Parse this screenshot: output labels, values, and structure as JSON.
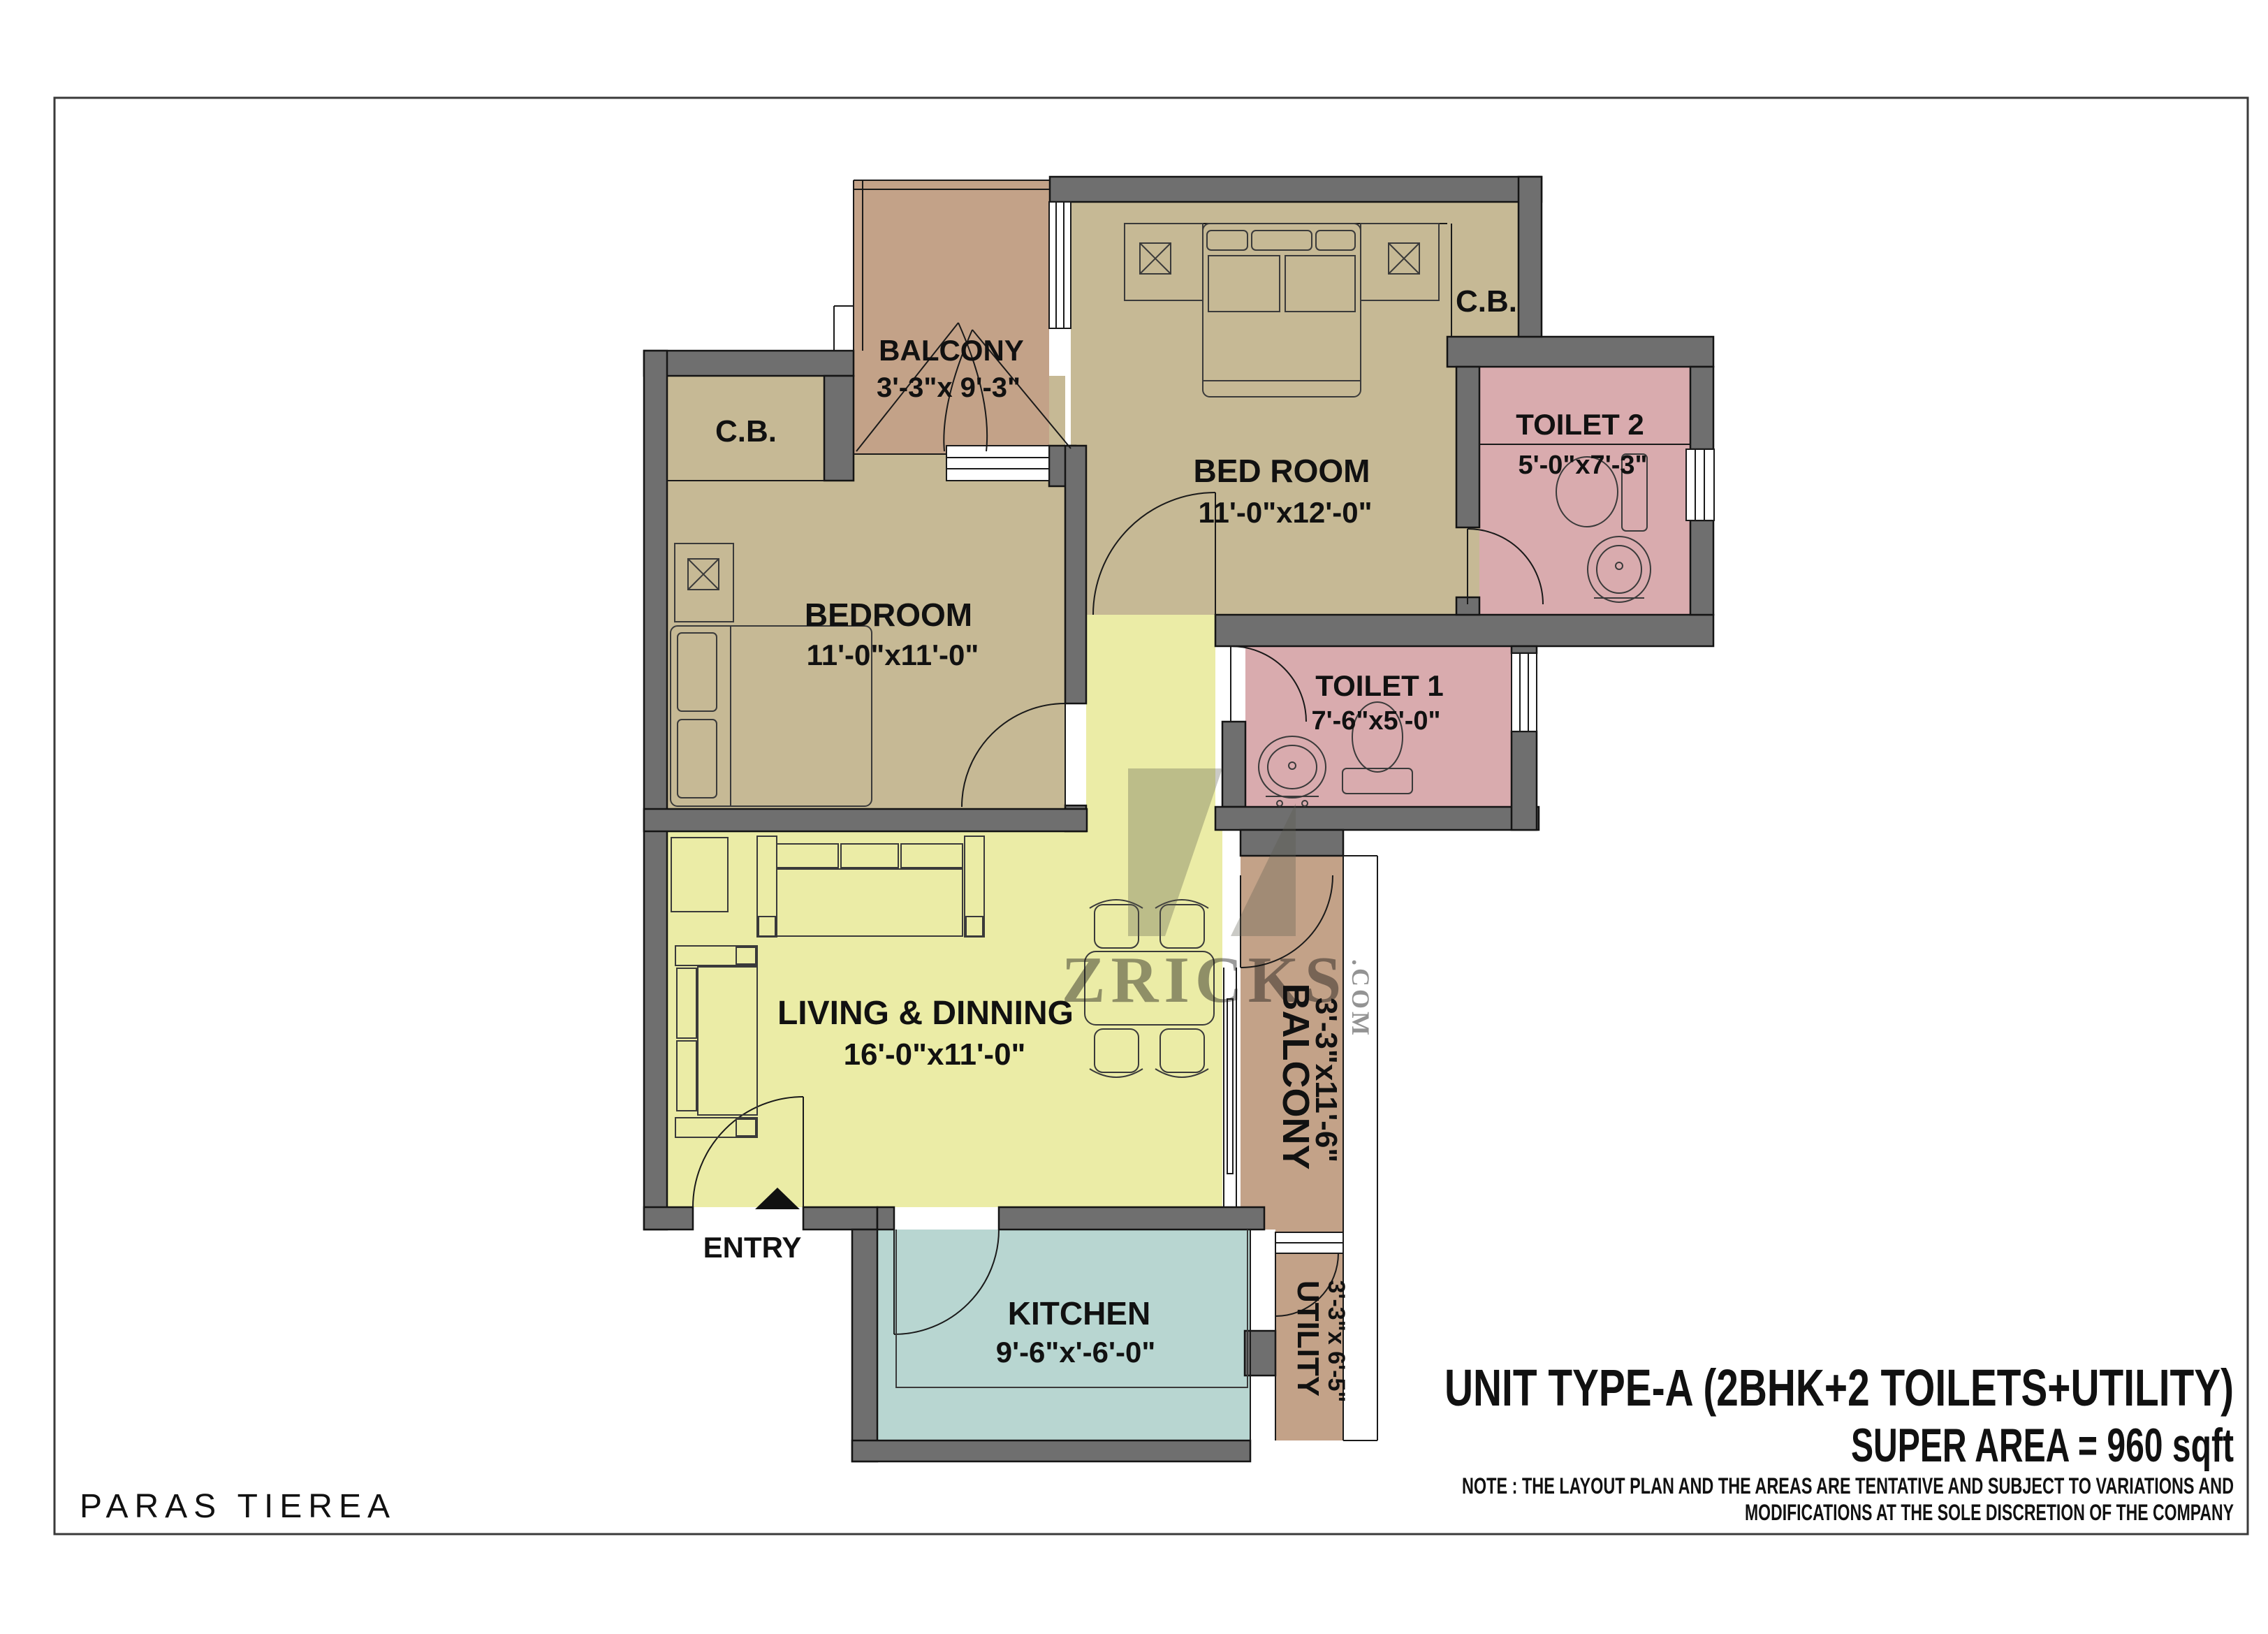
{
  "project": {
    "name": "PARAS TIEREA"
  },
  "title_block": {
    "unit_title": "UNIT TYPE-A (2BHK+2 TOILETS+UTILITY)",
    "super_area": "SUPER AREA = 960 sqft",
    "note_line1": "NOTE : THE LAYOUT PLAN AND THE AREAS ARE TENTATIVE AND SUBJECT TO VARIATIONS AND",
    "note_line2": "MODIFICATIONS AT THE SOLE DISCRETION OF THE COMPANY"
  },
  "watermark": {
    "name": "ZRICKS",
    "suffix": ".COM"
  },
  "rooms": {
    "balcony_top": {
      "name": "BALCONY",
      "dims": "3'-3\"x 9'-3\""
    },
    "bed_room": {
      "name": "BED ROOM",
      "dims": "11'-0\"x12'-0\""
    },
    "cb_right": {
      "name": "C.B."
    },
    "cb_left": {
      "name": "C.B."
    },
    "toilet_2": {
      "name": "TOILET 2",
      "dims": "5'-0\"x7'-3\""
    },
    "bedroom": {
      "name": "BEDROOM",
      "dims": "11'-0\"x11'-0\""
    },
    "toilet_1": {
      "name": "TOILET 1",
      "dims": "7'-6\"x5'-0\""
    },
    "living": {
      "name": "LIVING & DINNING",
      "dims": "16'-0\"x11'-0\""
    },
    "balcony_right": {
      "name": "BALCONY",
      "dims": "3'-3\"x11'-6\""
    },
    "kitchen": {
      "name": "KITCHEN",
      "dims": "9'-6\"x'-6'-0\""
    },
    "utility": {
      "name": "UTILITY",
      "dims": "3'-3\"x 6'-5\""
    },
    "entry": {
      "label": "ENTRY"
    }
  },
  "colors": {
    "wall": "#6f6f6f",
    "room_tan": "#c6b995",
    "balcony_brown": "#c3a288",
    "toilet_pink": "#d9abae",
    "living_yellow": "#ebeca6",
    "kitchen_blue": "#b8d6d1",
    "watermark": "#5a5b4d",
    "border": "#3a3a3a"
  }
}
